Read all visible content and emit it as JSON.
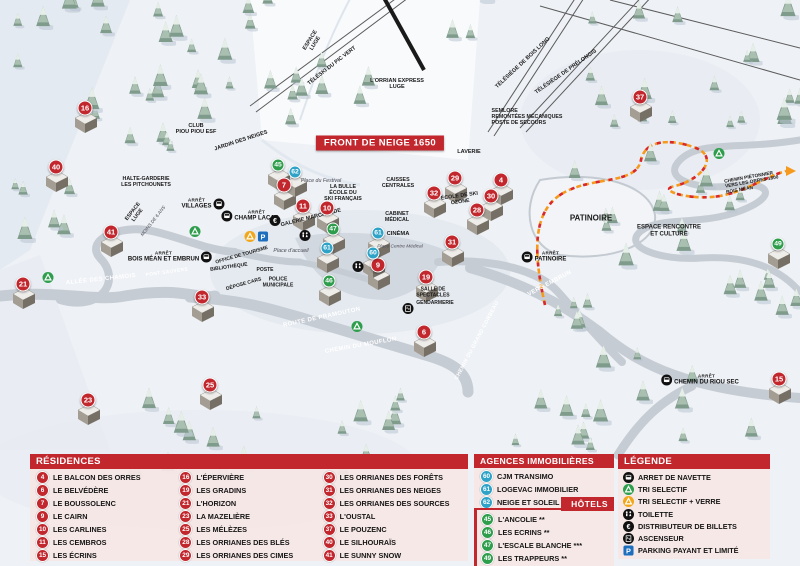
{
  "colors": {
    "accent_red": "#c1272d",
    "residence_red": "#c1272d",
    "hotel_green": "#2e9e4c",
    "agency_blue": "#2fa3c7",
    "parking_blue": "#1d6fbe",
    "recycle_green": "#2e9e4c",
    "recycle_yellow": "#f2a71b",
    "trail_orange": "#f59a1c",
    "trail_red": "#d8272d"
  },
  "map": {
    "banner": {
      "text": "FRONT DE NEIGE 1650",
      "x": 380,
      "y": 143
    },
    "markers": {
      "residences": [
        {
          "n": "16",
          "x": 85,
          "y": 108
        },
        {
          "n": "40",
          "x": 56,
          "y": 167
        },
        {
          "n": "41",
          "x": 111,
          "y": 232
        },
        {
          "n": "21",
          "x": 23,
          "y": 284
        },
        {
          "n": "23",
          "x": 88,
          "y": 400
        },
        {
          "n": "25",
          "x": 210,
          "y": 385
        },
        {
          "n": "33",
          "x": 202,
          "y": 297
        },
        {
          "n": "7",
          "x": 284,
          "y": 185
        },
        {
          "n": "11",
          "x": 303,
          "y": 206
        },
        {
          "n": "10",
          "x": 327,
          "y": 208
        },
        {
          "n": "9",
          "x": 378,
          "y": 265
        },
        {
          "n": "19",
          "x": 426,
          "y": 277
        },
        {
          "n": "6",
          "x": 424,
          "y": 332
        },
        {
          "n": "29",
          "x": 455,
          "y": 178
        },
        {
          "n": "32",
          "x": 434,
          "y": 193
        },
        {
          "n": "4",
          "x": 501,
          "y": 180
        },
        {
          "n": "30",
          "x": 491,
          "y": 196
        },
        {
          "n": "28",
          "x": 477,
          "y": 210
        },
        {
          "n": "31",
          "x": 452,
          "y": 242
        },
        {
          "n": "37",
          "x": 640,
          "y": 97
        },
        {
          "n": "15",
          "x": 779,
          "y": 379
        }
      ],
      "hotels": [
        {
          "n": "45",
          "x": 278,
          "y": 165
        },
        {
          "n": "47",
          "x": 333,
          "y": 229
        },
        {
          "n": "46",
          "x": 329,
          "y": 281
        },
        {
          "n": "49",
          "x": 778,
          "y": 244
        }
      ],
      "agencies": [
        {
          "n": "62",
          "x": 295,
          "y": 172
        },
        {
          "n": "61",
          "x": 378,
          "y": 233
        },
        {
          "n": "60",
          "x": 373,
          "y": 253
        },
        {
          "n": "61",
          "x": 327,
          "y": 248
        }
      ]
    },
    "bus_stops": {
      "arret_prefix": "ARRÊT",
      "stops": [
        {
          "name": "VILLAGES",
          "x": 203,
          "y": 204,
          "side": "r"
        },
        {
          "name": "CHAMP LACAS",
          "x": 250,
          "y": 216,
          "side": "l"
        },
        {
          "name": "BOIS MÉAN ET EMBRUN",
          "x": 170,
          "y": 257,
          "side": "r"
        },
        {
          "name": "PATINOIRE",
          "x": 544,
          "y": 257,
          "side": "l"
        },
        {
          "name": "CHEMIN DU RIOU SEC",
          "x": 700,
          "y": 380,
          "side": "l"
        }
      ]
    },
    "icons": [
      {
        "type": "recycle-green",
        "x": 195,
        "y": 233
      },
      {
        "type": "recycle-green",
        "x": 48,
        "y": 279
      },
      {
        "type": "recycle-green",
        "x": 357,
        "y": 328
      },
      {
        "type": "recycle-green",
        "x": 719,
        "y": 155
      },
      {
        "type": "recycle-yellow",
        "x": 250,
        "y": 238
      },
      {
        "type": "parking",
        "x": 263,
        "y": 238
      },
      {
        "type": "euro",
        "x": 275,
        "y": 222
      },
      {
        "type": "wc",
        "x": 305,
        "y": 237
      },
      {
        "type": "wc",
        "x": 358,
        "y": 268
      },
      {
        "type": "elevator",
        "x": 408,
        "y": 310
      }
    ],
    "labels": [
      {
        "t": "ESPACE\nLUGE",
        "x": 313,
        "y": 42,
        "r": -58,
        "s": 5.5
      },
      {
        "t": "L'ORRIAN EXPRESS\nLUGE",
        "x": 397,
        "y": 84,
        "s": 5.5
      },
      {
        "t": "TÉLÉSKI DU PIC VERT",
        "x": 332,
        "y": 66,
        "r": -38,
        "s": 5.5
      },
      {
        "t": "TÉLÉSIÈGE DE BOIS LONG",
        "x": 523,
        "y": 63,
        "r": -43,
        "s": 5.5
      },
      {
        "t": "TÉLÉSIÈGE DE PRÉLONGIS",
        "x": 566,
        "y": 72,
        "r": -35,
        "s": 5.5
      },
      {
        "t": "SEMLORE\nREMONTÉES MÉCANIQUES\nPOSTE DE SECOURS",
        "x": 527,
        "y": 118,
        "s": 5.3,
        "cls": "left"
      },
      {
        "t": "CLUB\nPIOU PIOU ESF",
        "x": 196,
        "y": 129,
        "s": 5.5
      },
      {
        "t": "JARDIN DES NEIGES",
        "x": 241,
        "y": 141,
        "r": -18,
        "s": 5.5
      },
      {
        "t": "LAVERIE",
        "x": 469,
        "y": 152,
        "s": 5.5
      },
      {
        "t": "HALTE-GARDERIE\nLES PITCHOUNETS",
        "x": 146,
        "y": 183,
        "s": 5.3
      },
      {
        "t": "LA BULLE\nÉCOLE DU\nSKI FRANÇAIS",
        "x": 343,
        "y": 194,
        "s": 5.3
      },
      {
        "t": "Place du Festival",
        "x": 321,
        "y": 182,
        "s": 5.3,
        "cls": "it"
      },
      {
        "t": "CAISSES\nCENTRALES",
        "x": 398,
        "y": 184,
        "s": 5.3
      },
      {
        "t": "ÉCOLE DE SKI\nOZONE",
        "x": 460,
        "y": 200,
        "r": -8,
        "s": 5.3
      },
      {
        "t": "GALERIE MARCHANDE",
        "x": 311,
        "y": 218,
        "r": -14,
        "s": 5.5
      },
      {
        "t": "CABINET\nMÉDICAL",
        "x": 397,
        "y": 218,
        "s": 5.3
      },
      {
        "t": "CINÉMA",
        "x": 398,
        "y": 234,
        "s": 5.8
      },
      {
        "t": "Place Centre Médical",
        "x": 400,
        "y": 247,
        "s": 4.8,
        "cls": "it"
      },
      {
        "t": "ESPACE\nLUGE",
        "x": 136,
        "y": 214,
        "r": -52,
        "s": 5.3
      },
      {
        "t": "MOINS DE 6 ANS",
        "x": 153,
        "y": 221,
        "r": -52,
        "s": 4.6,
        "cls": "it"
      },
      {
        "t": "PATINOIRE",
        "x": 591,
        "y": 219,
        "s": 8
      },
      {
        "t": "ESPACE RENCONTRE\nET CULTURE",
        "x": 669,
        "y": 231,
        "s": 6
      },
      {
        "t": "CHEMIN PIÉTONNIER\nVERS LES ORRES 1800\nBOIS MÉAN",
        "x": 752,
        "y": 183,
        "r": -10,
        "s": 4.8,
        "cls": "left"
      },
      {
        "t": "OFFICE DE TOURISME",
        "x": 242,
        "y": 256,
        "r": -16,
        "s": 5
      },
      {
        "t": "BIBLIOTHÈQUE",
        "x": 229,
        "y": 268,
        "r": -8,
        "s": 5
      },
      {
        "t": "POSTE",
        "x": 265,
        "y": 271,
        "s": 5
      },
      {
        "t": "DÉPOSE CARS",
        "x": 244,
        "y": 285,
        "r": -16,
        "s": 5
      },
      {
        "t": "POLICE\nMUNICIPALE",
        "x": 278,
        "y": 283,
        "s": 5
      },
      {
        "t": "Place d'accueil",
        "x": 291,
        "y": 252,
        "s": 5.3,
        "cls": "it"
      },
      {
        "t": "SALLE DE\nSPECTACLES",
        "x": 433,
        "y": 293,
        "s": 5
      },
      {
        "t": "GENDARMERIE",
        "x": 435,
        "y": 304,
        "s": 5
      },
      {
        "t": "ALLÉE DES CHAMOIS",
        "x": 101,
        "y": 280,
        "r": -6,
        "s": 6,
        "cls": "road"
      },
      {
        "t": "PONT SAUVERS",
        "x": 167,
        "y": 273,
        "r": -8,
        "s": 4.8,
        "cls": "road"
      },
      {
        "t": "ROUTE DE PRAMOUTON",
        "x": 322,
        "y": 318,
        "r": -12,
        "s": 6,
        "cls": "road"
      },
      {
        "t": "CHEMIN DU MOUFLON",
        "x": 361,
        "y": 346,
        "r": -10,
        "s": 6,
        "cls": "road"
      },
      {
        "t": "CHEMIN DU GRAND CORBEAU",
        "x": 478,
        "y": 341,
        "r": -62,
        "s": 5.3,
        "cls": "road"
      },
      {
        "t": "VERS EMBRUN",
        "x": 550,
        "y": 284,
        "r": -28,
        "s": 6,
        "cls": "road"
      }
    ]
  },
  "panels": {
    "residences": {
      "title": "RÉSIDENCES",
      "items": [
        {
          "n": "4",
          "name": "LE BALCON DES ORRES"
        },
        {
          "n": "6",
          "name": "LE BELVÉDÈRE"
        },
        {
          "n": "7",
          "name": "LE BOUSSOLENC"
        },
        {
          "n": "9",
          "name": "LE CAIRN"
        },
        {
          "n": "10",
          "name": "LES CARLINES"
        },
        {
          "n": "11",
          "name": "LES CEMBROS"
        },
        {
          "n": "15",
          "name": "LES ÉCRINS"
        },
        {
          "n": "16",
          "name": "L'ÉPERVIÈRE"
        },
        {
          "n": "19",
          "name": "LES GRADINS"
        },
        {
          "n": "21",
          "name": "L'HORIZON"
        },
        {
          "n": "23",
          "name": "LA MAZELIÈRE"
        },
        {
          "n": "25",
          "name": "LES MÉLÈZES"
        },
        {
          "n": "28",
          "name": "LES ORRIANES DES BLÉS"
        },
        {
          "n": "29",
          "name": "LES ORRIANES DES CIMES"
        },
        {
          "n": "30",
          "name": "LES ORRIANES DES FORÊTS"
        },
        {
          "n": "31",
          "name": "LES ORRIANES DES NEIGES"
        },
        {
          "n": "32",
          "name": "LES ORRIANES DES SOURCES"
        },
        {
          "n": "33",
          "name": "L'OUSTAL"
        },
        {
          "n": "37",
          "name": "LE POUZENC"
        },
        {
          "n": "40",
          "name": "LE SILHOURAÏS"
        },
        {
          "n": "41",
          "name": "LE SUNNY SNOW"
        }
      ]
    },
    "agencies": {
      "title": "AGENCES IMMOBILIÈRES",
      "items": [
        {
          "n": "60",
          "name": "CJM TRANSIMO"
        },
        {
          "n": "61",
          "name": "LOGEVAC IMMOBILIER"
        },
        {
          "n": "62",
          "name": "NEIGE ET SOLEIL"
        }
      ]
    },
    "hotels": {
      "title": "HÔTELS",
      "items": [
        {
          "n": "45",
          "name": "L'ANCOLIE **"
        },
        {
          "n": "46",
          "name": "LES ECRINS **"
        },
        {
          "n": "47",
          "name": "L'ESCALE BLANCHE ***"
        },
        {
          "n": "49",
          "name": "LES TRAPPEURS **"
        }
      ]
    },
    "legende": {
      "title": "LÉGENDE",
      "items": [
        {
          "icon": "bus",
          "label": "ARRET DE NAVETTE"
        },
        {
          "icon": "recycle-green",
          "label": "TRI SELECTIF"
        },
        {
          "icon": "recycle-yellow",
          "label": "TRI SELECTIF + VERRE"
        },
        {
          "icon": "wc",
          "label": "TOILETTE"
        },
        {
          "icon": "euro",
          "label": "DISTRIBUTEUR DE BILLETS"
        },
        {
          "icon": "elevator",
          "label": "ASCENSEUR"
        },
        {
          "icon": "parking",
          "label": "PARKING PAYANT ET LIMITÉ"
        }
      ]
    }
  }
}
